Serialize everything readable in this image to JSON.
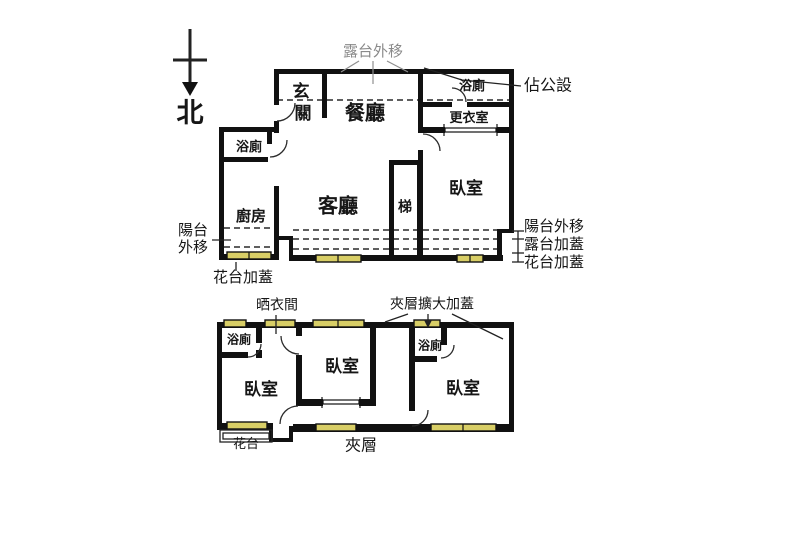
{
  "compass": {
    "north_label": "北"
  },
  "upper_floor": {
    "rooms": {
      "entry_char1": "玄",
      "entry_char2": "關",
      "dining": "餐廳",
      "bath_top_right": "浴廁",
      "dressing_room": "更衣室",
      "bath_left": "浴廁",
      "kitchen": "廚房",
      "living": "客廳",
      "stairs": "梯",
      "bedroom": "臥室"
    },
    "annotations": {
      "terrace_moved_out": "露台外移",
      "occupies_public_area": "佔公設",
      "balcony_moved_out_left": [
        "陽台",
        "外移"
      ],
      "flower_stand_cover_left": "花台加蓋",
      "balcony_moved_out_right": "陽台外移",
      "terrace_cover_right": "露台加蓋",
      "flower_stand_cover_right": "花台加蓋"
    }
  },
  "lower_floor": {
    "rooms": {
      "bath_left": "浴廁",
      "bedroom_left": "臥室",
      "bedroom_middle": "臥室",
      "bath_right": "浴廁",
      "bedroom_right": "臥室"
    },
    "annotations": {
      "laundry_drying_room": "晒衣間",
      "mezzanine_expanded_cover": "夾層擴大加蓋",
      "flower_stand": "花台",
      "mezzanine": "夾層"
    }
  },
  "colors": {
    "wall": "#111111",
    "window_fill": "#d8ce66",
    "annotation_gray": "#8a8a8a",
    "line": "#222222",
    "background": "#ffffff"
  }
}
